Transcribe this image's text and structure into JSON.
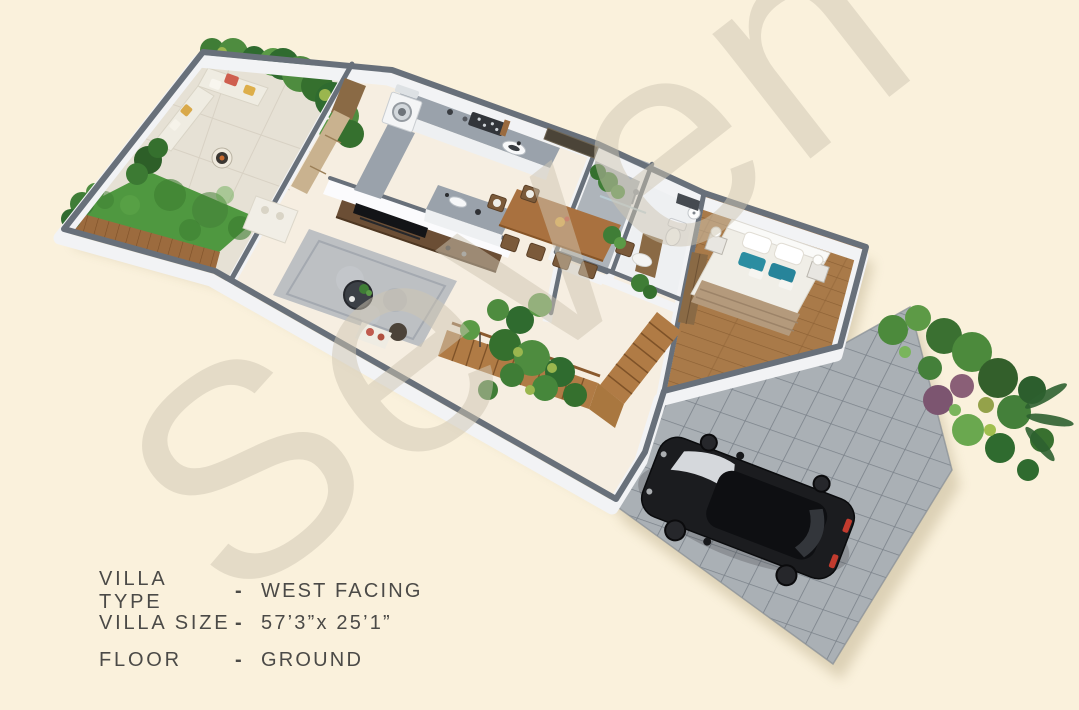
{
  "watermark": {
    "text": "Seven"
  },
  "info": {
    "rows": [
      {
        "label": "VILLA TYPE",
        "sep": "-",
        "value": "WEST FACING"
      },
      {
        "label": "VILLA SIZE",
        "sep": "-",
        "value": "57’3”x 25’1”"
      },
      {
        "label": "FLOOR",
        "sep": "-",
        "value": "GROUND"
      }
    ]
  },
  "palette": {
    "background": "#faf1dc",
    "wall_cap_gray": "#68707a",
    "floor_cream": "#f6eee1",
    "grass_green": "#4f9840",
    "bedroom_wood": "#a97a49",
    "deck_wood": "#9c6b3e",
    "stair_wood": "#b07b45",
    "driveway_tile": "#aab0b5",
    "kitchen_counter": "#9aa2ab",
    "car_black": "#1b1c1f",
    "bed_accent_teal": "#2b8da1",
    "plant_green": "#3f7d36",
    "label_text": "#4b4a47",
    "watermark_beige": "#cfc6b3"
  }
}
